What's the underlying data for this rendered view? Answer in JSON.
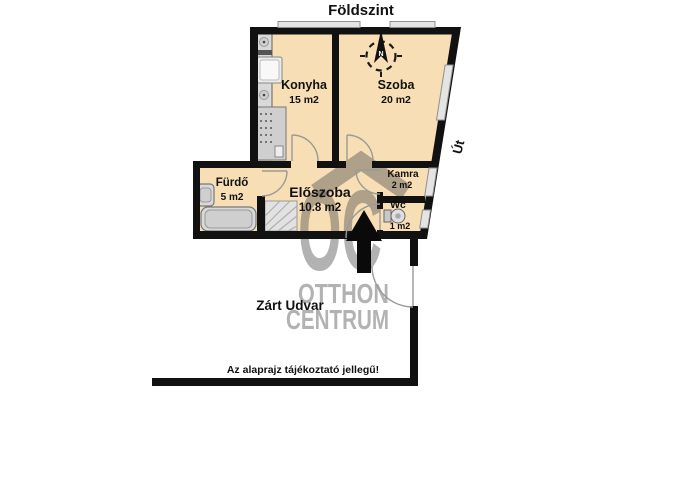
{
  "title": "Földszint",
  "rooms": [
    {
      "name": "Konyha",
      "area": "15 m2"
    },
    {
      "name": "Szoba",
      "area": "20 m2"
    },
    {
      "name": "Fürdő",
      "area": "5 m2"
    },
    {
      "name": "Előszoba",
      "area": "10.8 m2"
    },
    {
      "name": "Kamra",
      "area": "2 m2"
    },
    {
      "name": "Wc",
      "area": "1 m2"
    }
  ],
  "outdoor": {
    "road": "Út",
    "courtyard": "Zárt Udvar"
  },
  "compass": {
    "north": "N"
  },
  "watermark": {
    "logo": "OC",
    "line1": "OTTHON",
    "line2": "CENTRUM"
  },
  "disclaimer": "Az alaprajz tájékoztató jellegű!",
  "colors": {
    "floor": "#f7deb4",
    "wall": "#111111",
    "fixture": "#d9d9d9",
    "watermark_gray": "rgba(85,85,85,0.45)"
  }
}
